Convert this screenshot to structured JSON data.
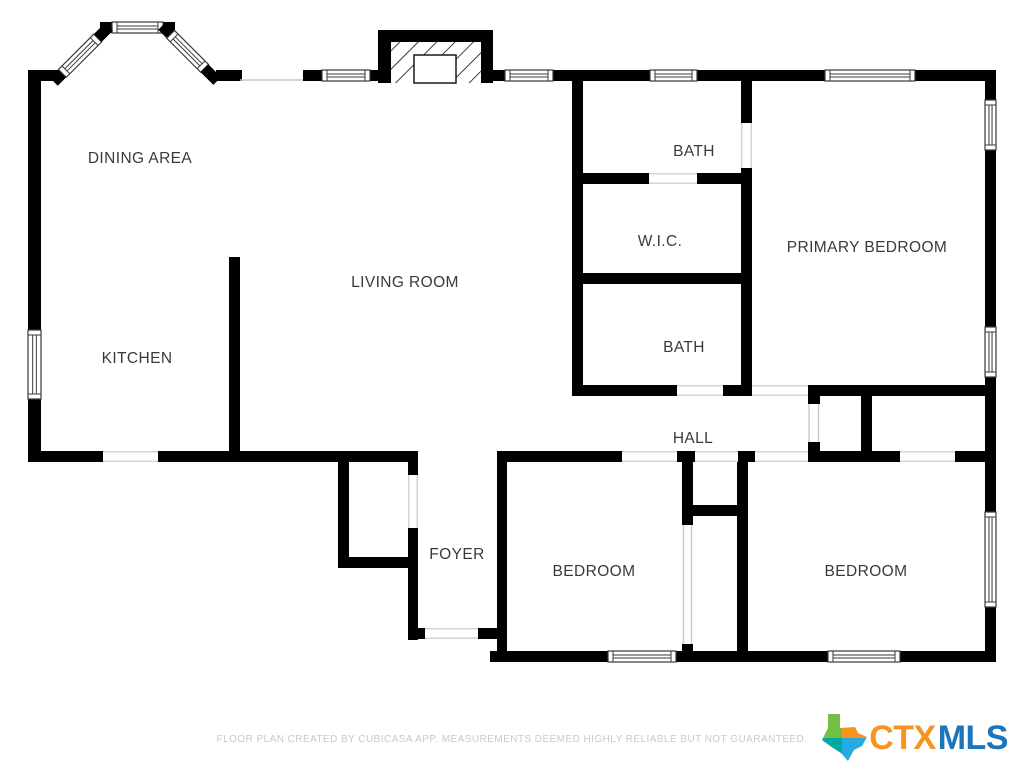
{
  "rooms": [
    {
      "label": "DINING AREA"
    },
    {
      "label": "LIVING ROOM"
    },
    {
      "label": "KITCHEN"
    },
    {
      "label": "BATH"
    },
    {
      "label": "W.I.C."
    },
    {
      "label": "PRIMARY BEDROOM"
    },
    {
      "label": "BATH"
    },
    {
      "label": "HALL"
    },
    {
      "label": "FOYER"
    },
    {
      "label": "BEDROOM"
    },
    {
      "label": "BEDROOM"
    }
  ],
  "footer": {
    "disclaimer": "FLOOR PLAN CREATED BY CUBICASA APP. MEASUREMENTS DEEMED HIGHLY RELIABLE BUT NOT GUARANTEED."
  },
  "logo": {
    "ctx": "CTX",
    "mls": "MLS"
  },
  "palette": {
    "wall": "#000000",
    "room_label": "#3a3a3a",
    "opening_line": "#c9c9c9",
    "footer_text": "#c9c9c9",
    "logo_ctx_orange": "#F7941E",
    "logo_mls_blue": "#1B75BC",
    "texas_green": "#72BF44",
    "texas_orange": "#F7941E",
    "texas_teal": "#00A99D",
    "texas_blue": "#27AAE1"
  }
}
